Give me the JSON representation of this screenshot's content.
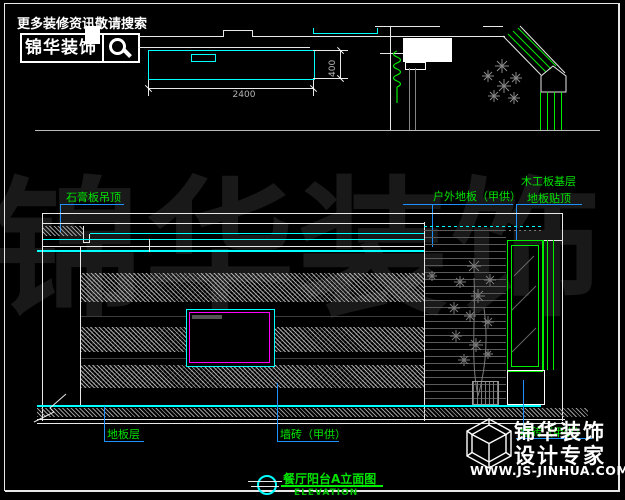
{
  "header": {
    "search_hint": "更多装修资讯敬请搜索",
    "brand": "锦华装饰"
  },
  "plan": {
    "dim_width": "2400",
    "dim_depth": "400"
  },
  "annotations": {
    "ceiling": "石膏板吊顶",
    "outdoor_floor": "户外地板（甲供）",
    "wood_board_line1": "木工板基层",
    "wood_board_line2": "地板贴顶",
    "floor_layer": "地板层",
    "wall_tile": "墙砖（甲供）",
    "wall_tile_2": "墙砖（甲供）"
  },
  "title_block": {
    "title": "餐厅阳台A立面图",
    "subtitle": "ELEVATION"
  },
  "footer": {
    "brand_top": "锦华装饰",
    "brand_bottom": "设计专家",
    "website": "WWW.JS-JINHUA.COM"
  },
  "watermark": "锦华装饰",
  "colors": {
    "line_cyan": "#00FFFF",
    "line_green": "#00EE00",
    "line_magenta": "#FF00FF",
    "leader_blue": "#1E90FF",
    "label_green": "#00E400"
  }
}
